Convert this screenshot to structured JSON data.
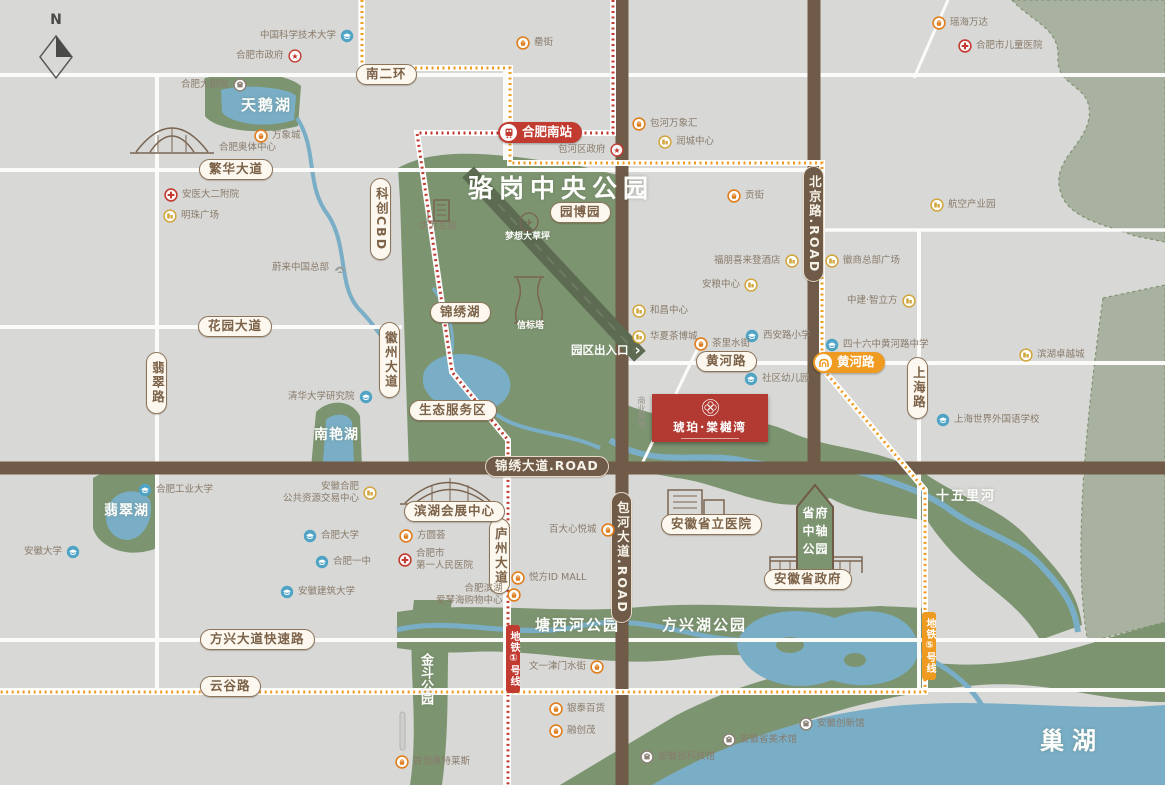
{
  "compass": {
    "label": "N"
  },
  "project": {
    "name": "琥珀·棠樾湾"
  },
  "park_arrow": {
    "lines": [
      "省府",
      "中轴",
      "公园"
    ]
  },
  "gate": {
    "label": "园区出入口"
  },
  "colors": {
    "metro_line1": "#c23b31",
    "metro_line5": "#ef9b22",
    "park_green": "#7d9471",
    "water_blue": "#79aec6",
    "road_brown": "#6f5b47",
    "project_red": "#b23a33"
  },
  "metro": {
    "station_south": {
      "label": "合肥南站",
      "x": 498,
      "y": 122
    },
    "station_huanghe": {
      "label": "黄河路",
      "x": 813,
      "y": 352
    },
    "line1": {
      "label": "地铁①号线",
      "x": 506,
      "y": 625
    },
    "line5": {
      "label": "地铁⑤号线",
      "x": 922,
      "y": 612
    }
  },
  "area_labels": [
    {
      "label": "骆岗中央公园",
      "x": 468,
      "y": 176,
      "fs": 25,
      "ls": 6
    },
    {
      "label": "天鹅湖",
      "x": 241,
      "y": 98,
      "fs": 15,
      "ls": 2
    },
    {
      "label": "南艳湖",
      "x": 314,
      "y": 428,
      "fs": 14,
      "ls": 1
    },
    {
      "label": "翡翠湖",
      "x": 104,
      "y": 504,
      "fs": 14,
      "ls": 1
    },
    {
      "label": "塘西河公园",
      "x": 535,
      "y": 618,
      "fs": 15,
      "ls": 2
    },
    {
      "label": "方兴湖公园",
      "x": 662,
      "y": 618,
      "fs": 15,
      "ls": 2
    },
    {
      "label": "金斗公园",
      "x": 419,
      "y": 653,
      "fs": 13,
      "vert": true
    },
    {
      "label": "巢湖",
      "x": 1040,
      "y": 729,
      "fs": 24,
      "ls": 8
    },
    {
      "label": "十五里河",
      "x": 936,
      "y": 490,
      "fs": 13,
      "ls": 2
    },
    {
      "label": "梦想大草坪",
      "x": 505,
      "y": 233,
      "fs": 9
    },
    {
      "label": "信标塔",
      "x": 517,
      "y": 322,
      "fs": 9
    },
    {
      "label": "商业用地",
      "x": 637,
      "y": 396,
      "fs": 8,
      "vert": true,
      "gray": true
    }
  ],
  "road_badges": [
    {
      "label": "南二环",
      "x": 356,
      "y": 64
    },
    {
      "label": "繁华大道",
      "x": 199,
      "y": 159
    },
    {
      "label": "花园大道",
      "x": 198,
      "y": 316
    },
    {
      "label": "翡翠路",
      "x": 146,
      "y": 352,
      "vert": true
    },
    {
      "label": "科创CBD",
      "x": 370,
      "y": 178,
      "vert": true
    },
    {
      "label": "徽州大道",
      "x": 379,
      "y": 322,
      "vert": true
    },
    {
      "label": "锦绣湖",
      "x": 430,
      "y": 302
    },
    {
      "label": "园博园",
      "x": 550,
      "y": 202
    },
    {
      "label": "生态服务区",
      "x": 409,
      "y": 400
    },
    {
      "label": "黄河路",
      "x": 696,
      "y": 351
    },
    {
      "label": "庐州大道",
      "x": 489,
      "y": 518,
      "vert": true
    },
    {
      "label": "上海路",
      "x": 907,
      "y": 357,
      "vert": true
    },
    {
      "label": "方兴大道快速路",
      "x": 200,
      "y": 629
    },
    {
      "label": "云谷路",
      "x": 200,
      "y": 676
    },
    {
      "label": "滨湖会展中心",
      "x": 404,
      "y": 501
    },
    {
      "label": "安徽省立医院",
      "x": 661,
      "y": 514
    },
    {
      "label": "安徽省政府",
      "x": 764,
      "y": 569
    }
  ],
  "brown_badges": [
    {
      "label": "锦绣大道.ROAD",
      "x": 485,
      "y": 456
    },
    {
      "label": "北京路.ROAD",
      "x": 803,
      "y": 166,
      "vert": true
    },
    {
      "label": "包河大道.ROAD",
      "x": 611,
      "y": 492,
      "vert": true
    }
  ],
  "pois": [
    {
      "label": "中国科学技术大学",
      "type": "edu",
      "side": "right",
      "x": 260,
      "y": 29
    },
    {
      "label": "合肥市政府",
      "type": "gov",
      "side": "right",
      "x": 236,
      "y": 49
    },
    {
      "label": "合肥大剧院",
      "type": "culture",
      "side": "right",
      "x": 181,
      "y": 78
    },
    {
      "label": "万象城",
      "type": "mall",
      "x": 254,
      "y": 129
    },
    {
      "label": "合肥奥体中心",
      "type": "none",
      "x": 219,
      "y": 142
    },
    {
      "label": "安医大二附院",
      "type": "hospital",
      "x": 164,
      "y": 188
    },
    {
      "label": "明珠广场",
      "type": "biz",
      "x": 163,
      "y": 209
    },
    {
      "label": "蔚来中国总部",
      "type": "nio",
      "side": "right",
      "x": 272,
      "y": 261
    },
    {
      "label": "清华大学研究院",
      "type": "edu",
      "side": "right",
      "x": 288,
      "y": 390
    },
    {
      "label": "合肥工业大学",
      "type": "edu",
      "x": 138,
      "y": 483
    },
    {
      "lines": [
        "安徽合肥",
        "公共资源交易中心"
      ],
      "type": "biz",
      "side": "right",
      "x": 283,
      "y": 481
    },
    {
      "label": "合肥大学",
      "type": "edu",
      "x": 303,
      "y": 529
    },
    {
      "label": "安徽大学",
      "type": "edu",
      "side": "right",
      "x": 24,
      "y": 545
    },
    {
      "label": "合肥一中",
      "type": "edu",
      "x": 315,
      "y": 555
    },
    {
      "label": "安徽建筑大学",
      "type": "edu",
      "x": 280,
      "y": 585
    },
    {
      "label": "华为总部",
      "type": "none",
      "x": 419,
      "y": 221
    },
    {
      "label": "罍街",
      "type": "mall",
      "x": 516,
      "y": 36
    },
    {
      "label": "包河区政府",
      "type": "gov",
      "side": "right",
      "x": 558,
      "y": 143
    },
    {
      "label": "包河万象汇",
      "type": "mall",
      "x": 632,
      "y": 117
    },
    {
      "label": "润城中心",
      "type": "biz",
      "x": 658,
      "y": 135
    },
    {
      "label": "瑶海万达",
      "type": "mall",
      "x": 932,
      "y": 16
    },
    {
      "label": "合肥市儿童医院",
      "type": "hospital",
      "x": 958,
      "y": 39
    },
    {
      "label": "航空产业园",
      "type": "biz",
      "x": 930,
      "y": 198
    },
    {
      "label": "贡街",
      "type": "mall",
      "x": 727,
      "y": 189
    },
    {
      "label": "福朋喜来登酒店",
      "type": "biz",
      "side": "right",
      "x": 714,
      "y": 254
    },
    {
      "label": "徽商总部广场",
      "type": "biz",
      "x": 825,
      "y": 254
    },
    {
      "label": "安粮中心",
      "type": "biz",
      "side": "right",
      "x": 702,
      "y": 278
    },
    {
      "label": "中建·智立方",
      "type": "biz",
      "side": "right",
      "x": 847,
      "y": 294
    },
    {
      "label": "和昌中心",
      "type": "biz",
      "x": 632,
      "y": 304
    },
    {
      "label": "华夏茶博城",
      "type": "biz",
      "x": 632,
      "y": 330
    },
    {
      "label": "西安路小学",
      "type": "edu",
      "x": 745,
      "y": 329
    },
    {
      "label": "茶里水街",
      "type": "mall",
      "x": 694,
      "y": 337
    },
    {
      "label": "四十六中黄河路中学",
      "type": "edu",
      "x": 825,
      "y": 338
    },
    {
      "label": "滨湖卓越城",
      "type": "biz",
      "x": 1019,
      "y": 348
    },
    {
      "label": "社区幼儿园",
      "type": "edu",
      "x": 744,
      "y": 372
    },
    {
      "label": "上海世界外国语学校",
      "type": "edu",
      "x": 936,
      "y": 413
    },
    {
      "label": "方圆荟",
      "type": "mall",
      "x": 399,
      "y": 529
    },
    {
      "lines": [
        "合肥市",
        "第一人民医院"
      ],
      "type": "hospital",
      "x": 398,
      "y": 548
    },
    {
      "lines": [
        "合肥滨湖",
        "爱琴海购物中心"
      ],
      "type": "mall",
      "side": "right",
      "x": 436,
      "y": 583
    },
    {
      "label": "百大心悦城",
      "type": "mall",
      "side": "right",
      "x": 549,
      "y": 523
    },
    {
      "label": "悦方ID MALL",
      "type": "mall",
      "x": 511,
      "y": 571
    },
    {
      "label": "文一津门水街",
      "type": "mall",
      "side": "right",
      "x": 529,
      "y": 660
    },
    {
      "label": "银泰百货",
      "type": "mall",
      "x": 549,
      "y": 702
    },
    {
      "label": "融创茂",
      "type": "mall",
      "x": 549,
      "y": 724
    },
    {
      "label": "首创奥特莱斯",
      "type": "mall",
      "x": 395,
      "y": 755
    },
    {
      "label": "安徽省科技馆",
      "type": "culture",
      "x": 640,
      "y": 750
    },
    {
      "label": "安徽省美术馆",
      "type": "culture",
      "x": 722,
      "y": 733
    },
    {
      "label": "安徽创新馆",
      "type": "culture",
      "x": 799,
      "y": 717
    }
  ]
}
